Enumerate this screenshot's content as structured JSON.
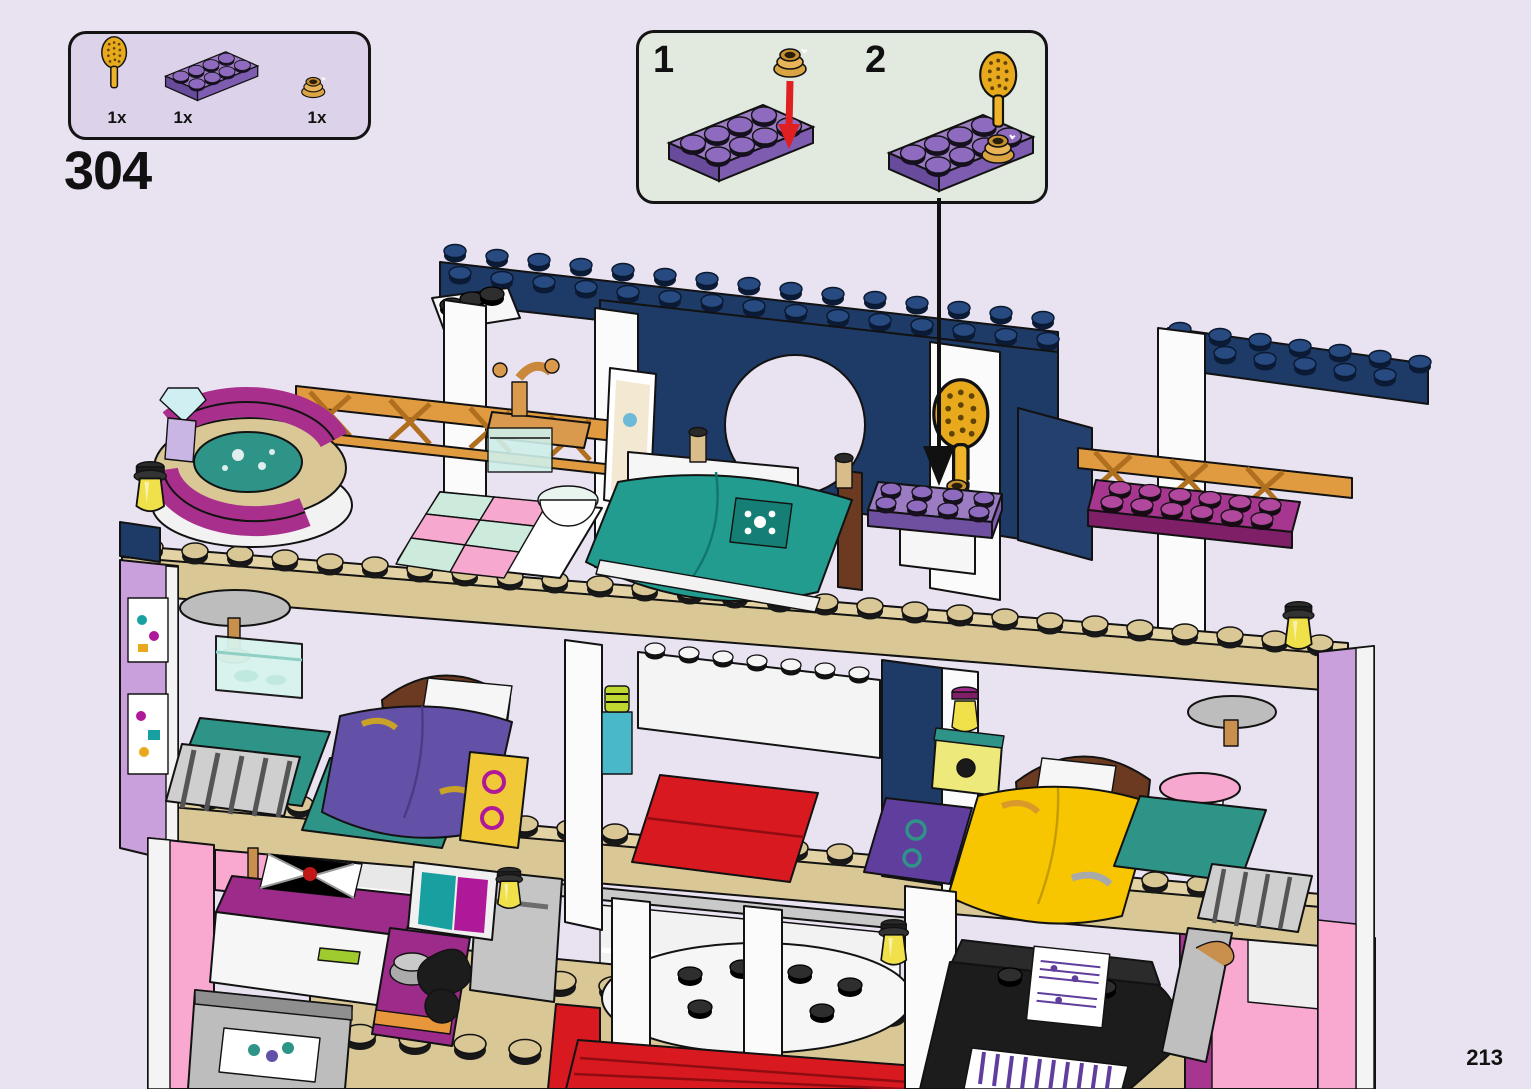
{
  "page": {
    "step_number": "304",
    "page_number": "213",
    "background": "#E9E2F0"
  },
  "parts_box": {
    "background": "#DCD2E9",
    "parts": [
      {
        "name": "hairbrush-gold",
        "qty": "1x"
      },
      {
        "name": "plate-2x4-medium-lavender",
        "qty": "1x"
      },
      {
        "name": "round-plate-1x1-gold",
        "qty": "1x"
      }
    ]
  },
  "callout": {
    "background": "#E2EADF",
    "steps": [
      {
        "number": "1",
        "part": "round-plate-1x1-gold",
        "target": "plate-2x4-medium-lavender"
      },
      {
        "number": "2",
        "part": "hairbrush-gold",
        "target": "round-plate-1x1-gold"
      }
    ]
  },
  "model": {
    "subject": "three-story-dollhouse-interior-back-view",
    "colors": {
      "roof_navy": "#1E3A66",
      "floor_tan": "#D9C795",
      "wall_pink": "#F9A8D0",
      "wall_lavender": "#C9A0DC",
      "accent_magenta": "#A8308C",
      "bed_teal": "#239C90",
      "bed_purple": "#6351A8",
      "bed_yellow": "#F7C600",
      "carpet_red": "#D8191F",
      "gold": "#E8A91C",
      "plate_lavender": "#9B7CC2"
    }
  }
}
